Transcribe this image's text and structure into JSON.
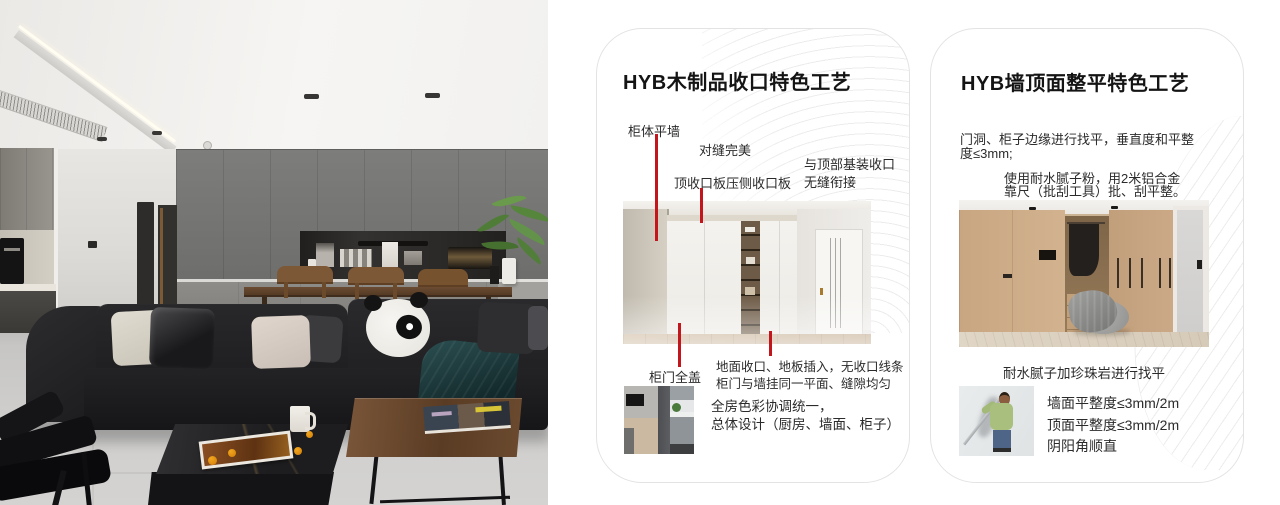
{
  "colors": {
    "accent_red": "#c3161c",
    "card_border": "#e3e3e3",
    "title_text": "#141414",
    "body_text": "#2b2b2b",
    "pattern_line": "#ececec"
  },
  "card1": {
    "title": "HYB木制品收口特色工艺",
    "callout_cabinet_flush_wall": "柜体平墙",
    "callout_perfect_seam": "对缝完美",
    "callout_top_panel": "顶收口板压侧收口板",
    "callout_ceiling_joint_line1": "与顶部基装收口",
    "callout_ceiling_joint_line2": "无缝衔接",
    "callout_full_cover_door": "柜门全盖",
    "floor_note_line1": "地面收口、地板插入，无收口线条",
    "floor_note_line2": "柜门与墙挂同一平面、缝隙均匀",
    "summary_line1": "全房色彩协调统一，",
    "summary_line2": "总体设计（厨房、墙面、柜子）"
  },
  "card2": {
    "title": "HYB墙顶面整平特色工艺",
    "para1_line1": "门洞、柜子边缘进行找平，垂直度和平整",
    "para1_line2": "度≤3mm;",
    "para2_line1": "使用耐水腻子粉，用2米铝合金",
    "para2_line2": "靠尺（批刮工具）批、刮平整。",
    "image_caption": "耐水腻子加珍珠岩进行找平",
    "metric_wall": "墙面平整度≤3mm/2m",
    "metric_ceiling": "顶面平整度≤3mm/2m",
    "metric_corner": "阴阳角顺直"
  }
}
